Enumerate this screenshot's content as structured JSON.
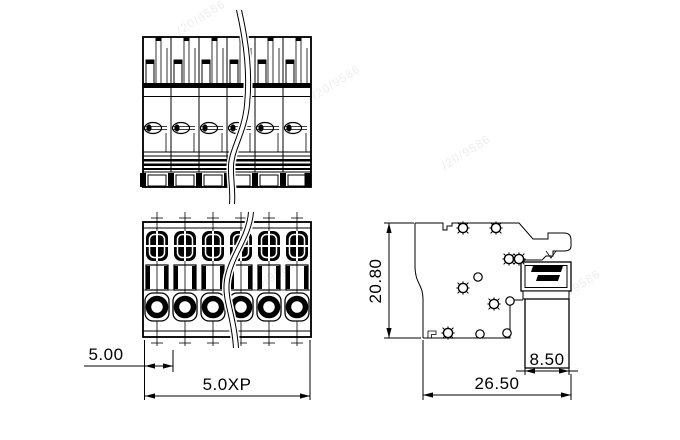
{
  "drawing": {
    "dimensions": {
      "pitch": "5.00",
      "total_width": "5.0XP",
      "body_height": "20.80",
      "foot_depth": "8.50",
      "total_depth": "26.50"
    },
    "watermark": {
      "text": "/20/9586"
    }
  }
}
